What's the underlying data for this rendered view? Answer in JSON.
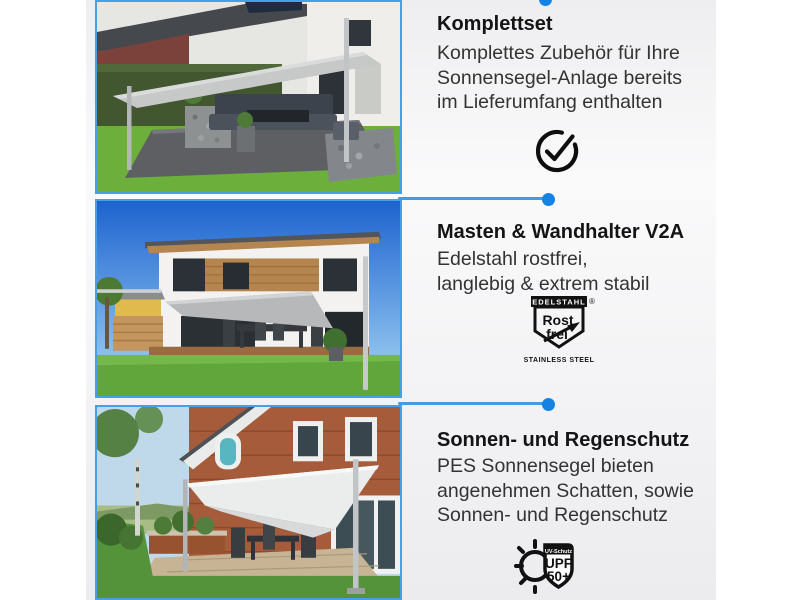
{
  "theme": {
    "accent_line": "#3f9ce9",
    "accent_dot": "#1583e3",
    "photo_border": "#43a1ea",
    "panel_bg": "#f1f1f3",
    "title_color": "#141414",
    "body_color": "#333333"
  },
  "sections": [
    {
      "title": "Komplettset",
      "body_lines": [
        "Komplettes Zubehör für Ihre",
        "Sonnensegel-Anlage bereits",
        "im Lieferumfang enthalten"
      ],
      "icon": "check-circle-icon",
      "photo_alt": "Terrasse mit anthrazitfarbener Gartenlounge unter Sonnensegel mit Edelstahlmasten vor Haus und Hecke"
    },
    {
      "title": "Masten & Wandhalter V2A",
      "body_lines": [
        "Edelstahl rostfrei,",
        "langlebig & extrem stabil"
      ],
      "icon": "rostfrei-badge-icon",
      "badge": {
        "top_label": "EDELSTAHL",
        "word1": "Rost",
        "word2": "frei",
        "registered": "®",
        "bottom_label": "STAINLESS STEEL"
      },
      "photo_alt": "Weißes modernes Haus mit grauem Sonnensegel über Holzterrasse bei blauem Himmel"
    },
    {
      "title": "Sonnen- und Regenschutz",
      "body_lines": [
        "PES Sonnensegel bieten",
        "angenehmen Schatten, sowie",
        "Sonnen- und Regenschutz"
      ],
      "icon": "upf-badge-icon",
      "badge": {
        "top_label": "UV-Schutz",
        "line1": "UPF",
        "line2": "50+"
      },
      "photo_alt": "Klinkerhaus mit hellem Sonnensegel an Edelstahlmasten über Steinterrasse"
    }
  ]
}
